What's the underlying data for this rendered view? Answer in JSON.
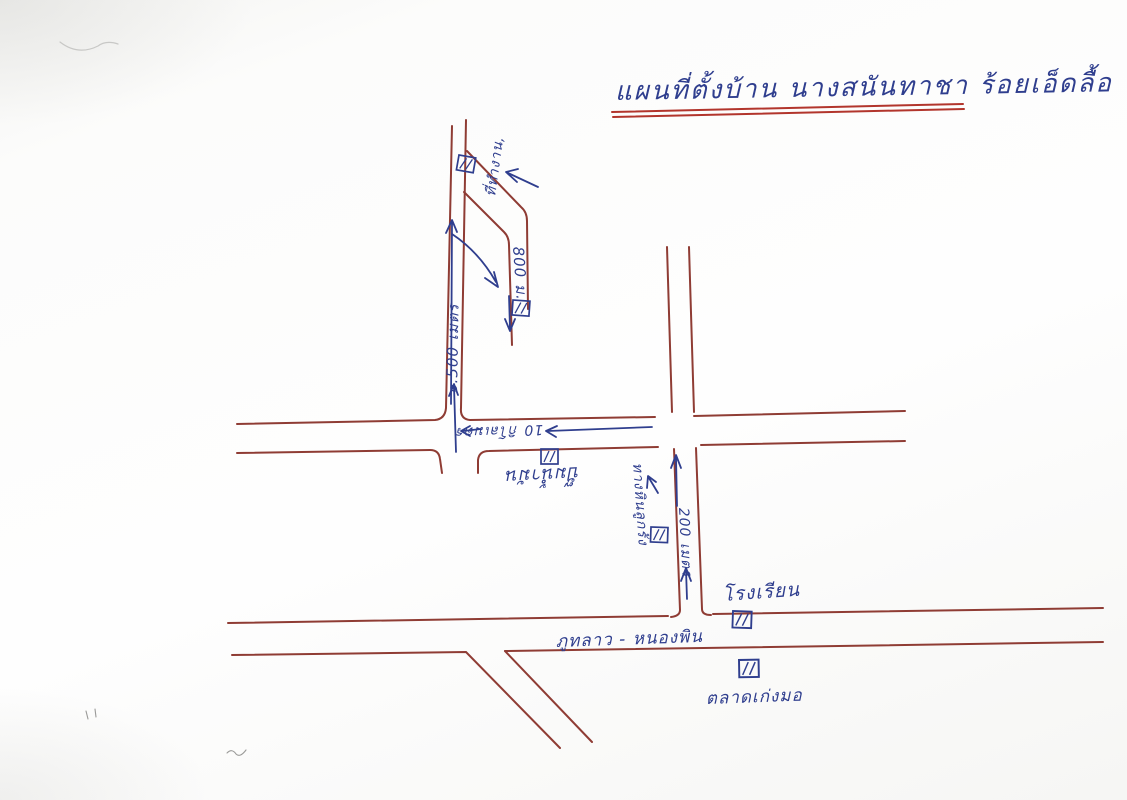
{
  "title": {
    "text": "แผนที่ตั้งบ้าน นางสนันทาชา ร้อยเอ็ดลื้อ"
  },
  "map": {
    "labels": {
      "workplace": "ที่ทำงาน,",
      "dead_end_distance": "800 ม.",
      "main_road_distance": "๑.500 เมตร",
      "highway_distance": "10 กิโลเมตร",
      "fuel_station": "ปั๊มน้ำมัน",
      "gravel_road": "ทางหินลูกรัง",
      "side_road_distance": "200 เมตร",
      "school": "โรงเรียน",
      "bottom_road_name": "ภูทลาว - หนองพิน",
      "market": "ตลาดเก่งมอ"
    },
    "icons": {
      "building": "hatched-rectangle-building-marker",
      "arrows": "hand-drawn-direction-arrows"
    },
    "colors": {
      "road": "#8f3c34",
      "ink": "#2f3e8e",
      "title_underline": "#b2352c"
    }
  }
}
